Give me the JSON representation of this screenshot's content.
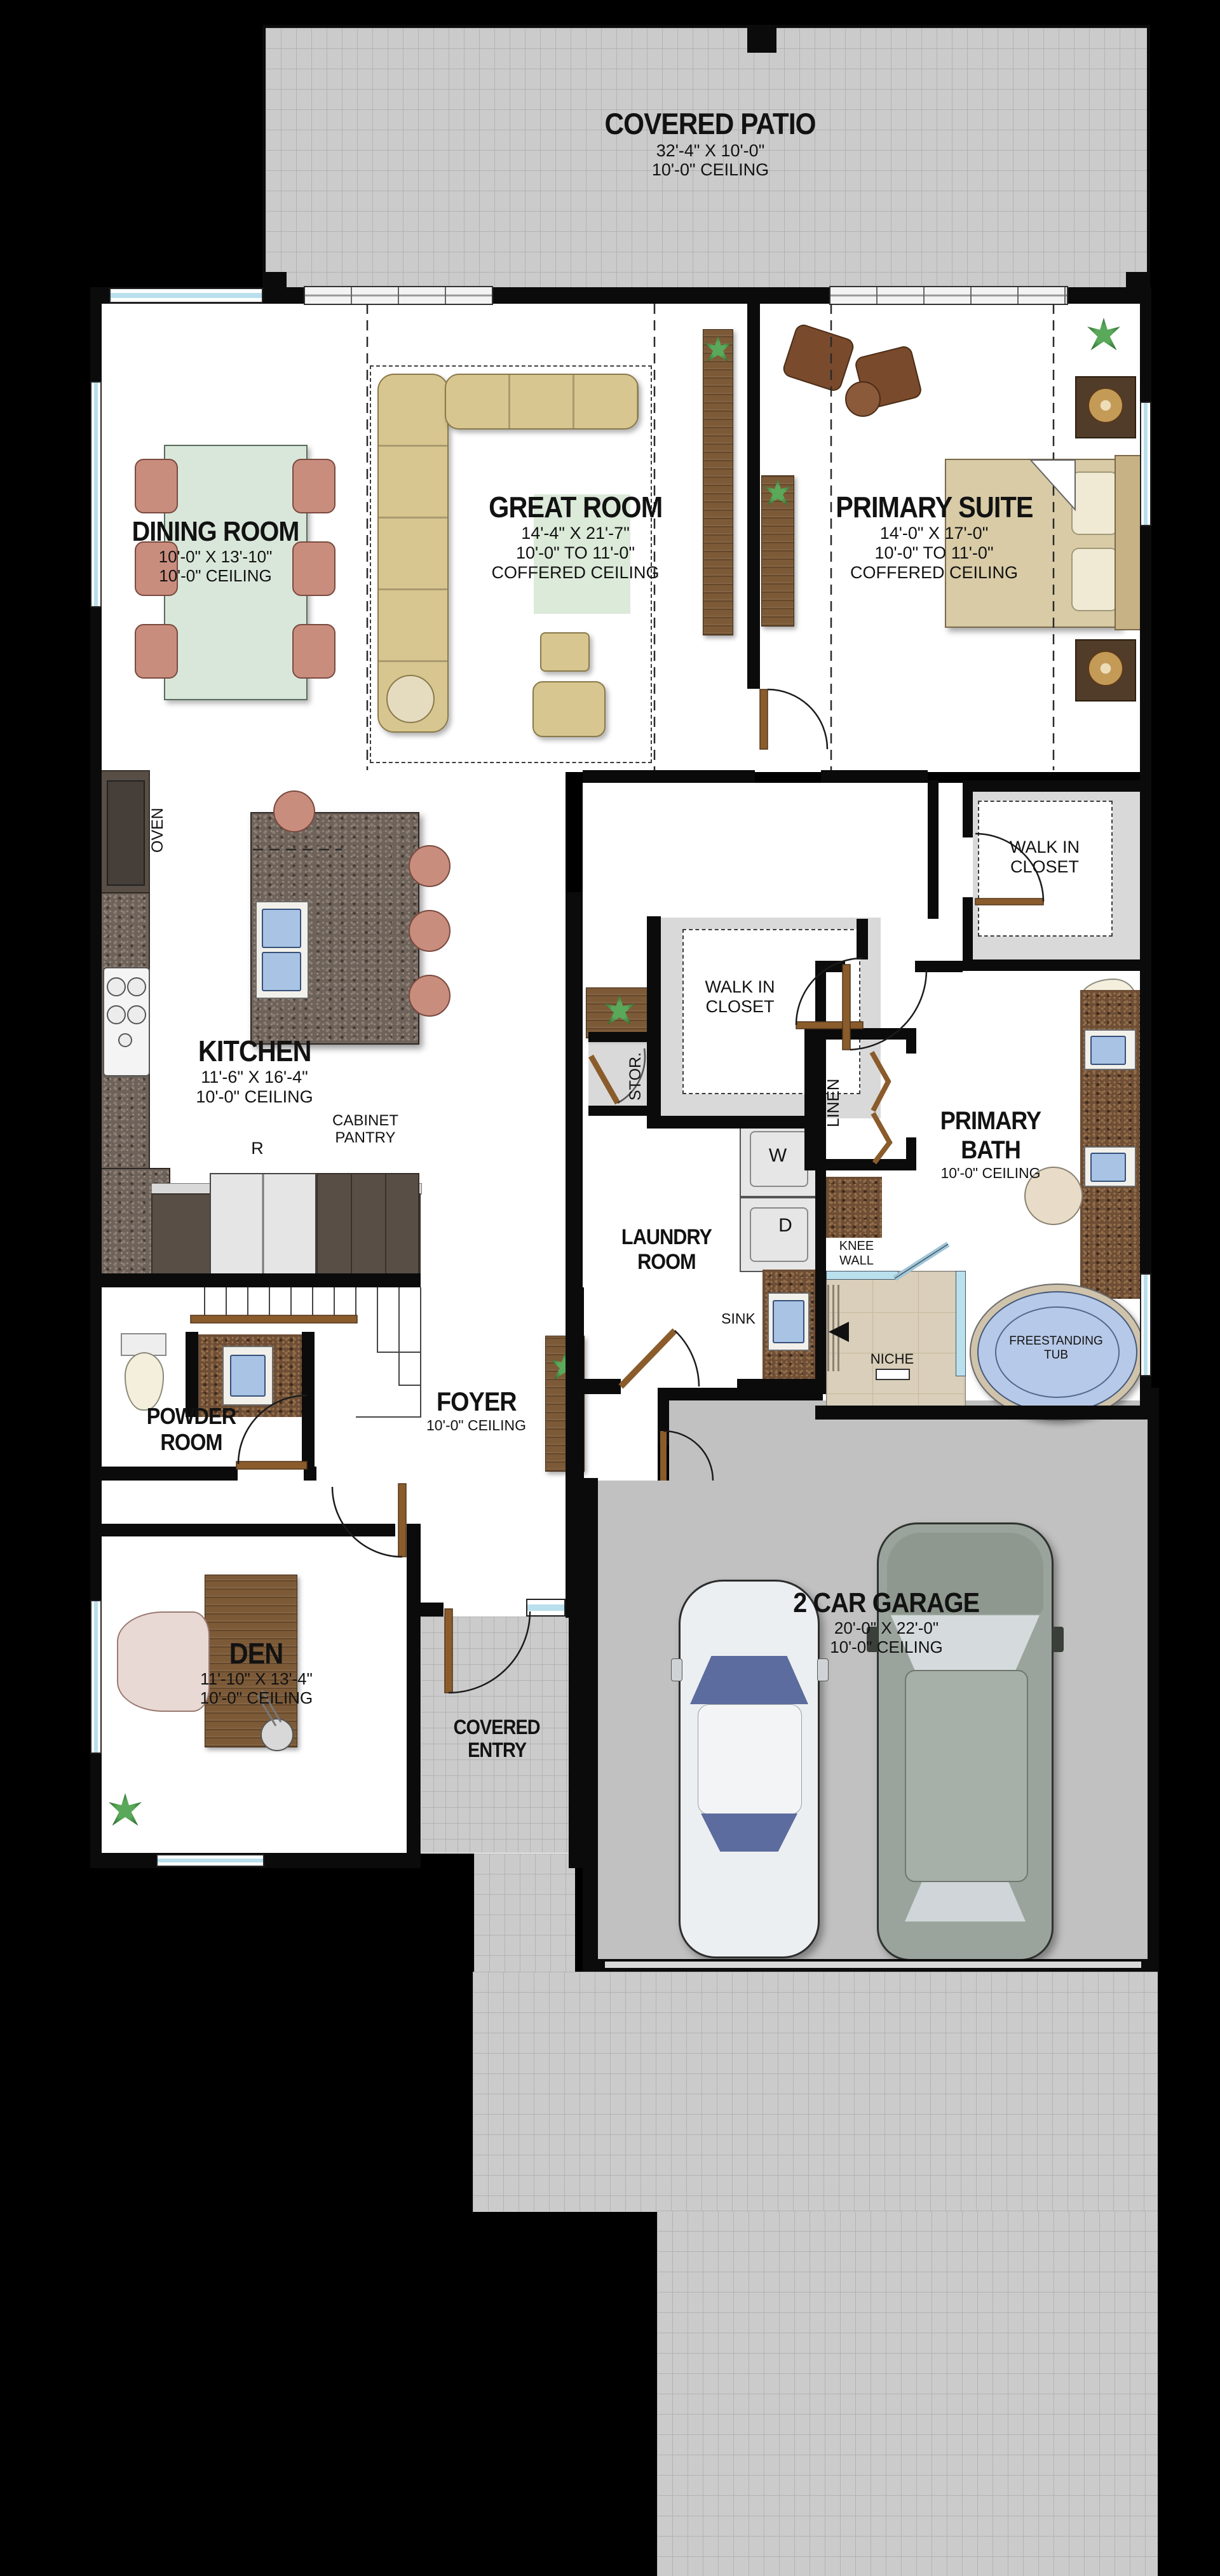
{
  "plan": {
    "rooms": {
      "covered_patio": {
        "name": "COVERED PATIO",
        "dims": "32'-4\" X 10'-0\"",
        "ceiling": "10'-0\" CEILING"
      },
      "dining_room": {
        "name": "DINING ROOM",
        "dims": "10'-0\" X 13'-10\"",
        "ceiling": "10'-0\" CEILING"
      },
      "great_room": {
        "name": "GREAT ROOM",
        "dims": "14'-4\" X 21'-7\"",
        "ceiling": "10'-0\" TO 11'-0\"",
        "ceiling2": "COFFERED CEILING"
      },
      "primary_suite": {
        "name": "PRIMARY SUITE",
        "dims": "14'-0\" X 17'-0\"",
        "ceiling": "10'-0\" TO 11'-0\"",
        "ceiling2": "COFFERED CEILING"
      },
      "kitchen": {
        "name": "KITCHEN",
        "dims": "11'-6\" X 16'-4\"",
        "ceiling": "10'-0\" CEILING"
      },
      "walk_in_closet_hall": {
        "line1": "WALK IN",
        "line2": "CLOSET"
      },
      "walk_in_closet_primary": {
        "line1": "WALK IN",
        "line2": "CLOSET"
      },
      "laundry_room": {
        "line1": "LAUNDRY",
        "line2": "ROOM"
      },
      "primary_bath": {
        "line1": "PRIMARY",
        "line2": "BATH",
        "ceiling": "10'-0\" CEILING"
      },
      "powder_room": {
        "line1": "POWDER",
        "line2": "ROOM"
      },
      "foyer": {
        "name": "FOYER",
        "ceiling": "10'-0\" CEILING"
      },
      "den": {
        "name": "DEN",
        "dims": "11'-10\" X 13'-4\"",
        "ceiling": "10'-0\" CEILING"
      },
      "covered_entry": {
        "line1": "COVERED",
        "line2": "ENTRY"
      },
      "garage": {
        "name": "2 CAR GARAGE",
        "dims": "20'-0\" X 22'-0\"",
        "ceiling": "10'-0\" CEILING"
      }
    },
    "annotations": {
      "oven": "OVEN",
      "refrigerator": "R",
      "cabinet_pantry_line1": "CABINET",
      "cabinet_pantry_line2": "PANTRY",
      "storage": "STOR.",
      "linen": "LINEN",
      "sink": "SINK",
      "washer": "W",
      "dryer": "D",
      "knee_wall_line1": "KNEE",
      "knee_wall_line2": "WALL",
      "niche": "NICHE",
      "tub_line1": "FREESTANDING",
      "tub_line2": "TUB"
    },
    "colors": {
      "background": "#000000",
      "wall": "#0b0b0b",
      "floor": "#ffffff",
      "patio_paver": "#cbcbcb",
      "garage_floor": "#c2c1c1",
      "closet_band": "#d9d9d9",
      "granite_gray": "#6e635b",
      "granite_brown": "#6f4e36",
      "cabinet_dark": "#584e46",
      "wood": "#7c5a38",
      "door_wood": "#8a5c2c",
      "window_glass": "#b9e0ec",
      "dining_table": "#d9e7da",
      "chair_upholstery": "#c98d7e",
      "sofa": "#d8c690",
      "bed": "#d8cba6",
      "rug_accent": "#dcead9",
      "sink_fixture": "#a9c3e4",
      "tub_fill": "#b7c9e8",
      "shower_tile": "#d9cfba",
      "car_sedan_body": "#eceff1",
      "car_suv_body": "#9aa49c",
      "car_glass": "#5d6c9e"
    }
  }
}
